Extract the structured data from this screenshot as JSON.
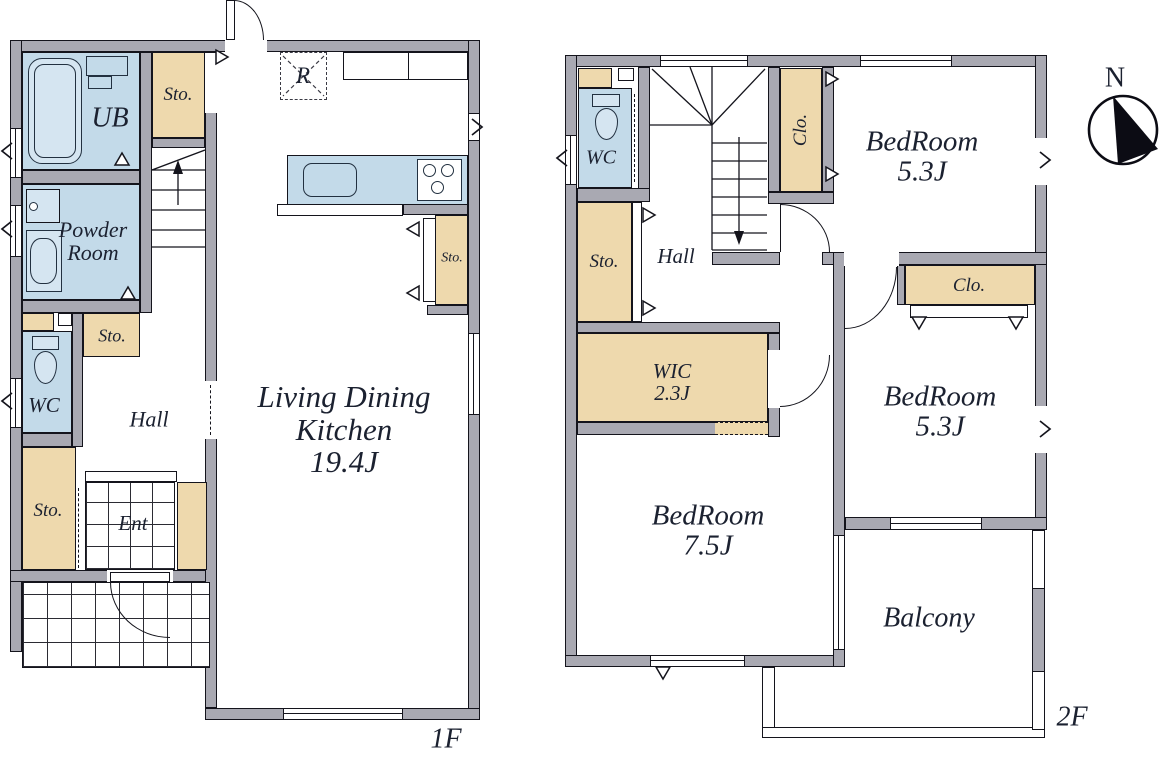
{
  "compass": {
    "north_label": "N"
  },
  "colors": {
    "wall_fill": "#a9a9b2",
    "outline": "#14141c",
    "wet_area_fill": "#c3dae9",
    "fixture_fill": "#d5e5f1",
    "storage_fill": "#eed9ad",
    "text": "#1b2130"
  },
  "floor1": {
    "floor_label": "1F",
    "rooms": {
      "unit_bath": "UB",
      "storage_top": "Sto.",
      "powder_room": "Powder Room",
      "storage_mid": "Sto.",
      "toilet": "WC",
      "hall": "Hall",
      "storage_lower": "Sto.",
      "entrance": "Ent",
      "ldk_name": "Living Dining Kitchen",
      "ldk_size": "19.4J",
      "refrigerator": "R",
      "storage_ldk": "Sto."
    }
  },
  "floor2": {
    "floor_label": "2F",
    "rooms": {
      "toilet": "WC",
      "storage": "Sto.",
      "hall": "Hall",
      "closet_north": "Clo.",
      "bedroom_ne_name": "BedRoom",
      "bedroom_ne_size": "5.3J",
      "closet_east": "Clo.",
      "bedroom_se_name": "BedRoom",
      "bedroom_se_size": "5.3J",
      "wic_name": "WIC",
      "wic_size": "2.3J",
      "bedroom_sw_name": "BedRoom",
      "bedroom_sw_size": "7.5J",
      "balcony": "Balcony"
    }
  }
}
